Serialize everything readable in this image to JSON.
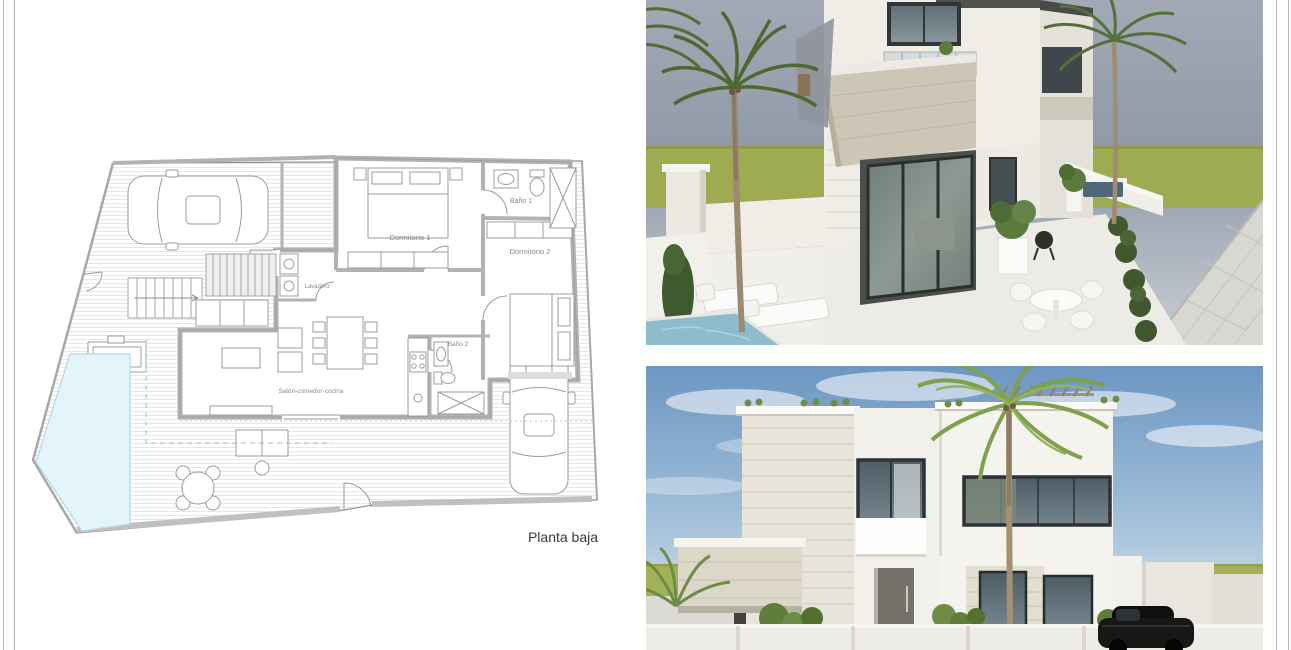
{
  "page": {
    "background": "#ffffff",
    "frame_line_color": "#b5b5b5"
  },
  "floor_plan": {
    "caption": "Planta baja",
    "rooms": [
      {
        "label": "Dormitorio 1"
      },
      {
        "label": "Baño 1"
      },
      {
        "label": "Dormitorio 2"
      },
      {
        "label": "Lavadero"
      },
      {
        "label": "Baño 2"
      },
      {
        "label": "Salón-comedor-cocina"
      }
    ],
    "colors": {
      "pool": "#e4f4fb",
      "walls": "#b2b2b2",
      "lines": "#9a9a9a",
      "labels": "#8a8a8a",
      "caption": "#3b3b3b"
    }
  },
  "renders": {
    "top": {
      "colors": {
        "sky_top": "#a2a9b5",
        "sky_mid": "#8f99a8",
        "sky_bottom": "#c9ced5",
        "grass": "#9fab50",
        "wall_light": "#efede6",
        "stone_balcony": "#cdc6b6",
        "glass": "#7d8a85",
        "pool": "#8fbccc",
        "palm_green": "#55713a"
      }
    },
    "bottom": {
      "colors": {
        "sky_top": "#6d96c2",
        "sky_bottom": "#e9eff4",
        "grass": "#a4b055",
        "wall_light": "#f4f2ec",
        "glass": "#4e5c66",
        "palm_green": "#7fa04c",
        "car": "#171717"
      }
    }
  }
}
